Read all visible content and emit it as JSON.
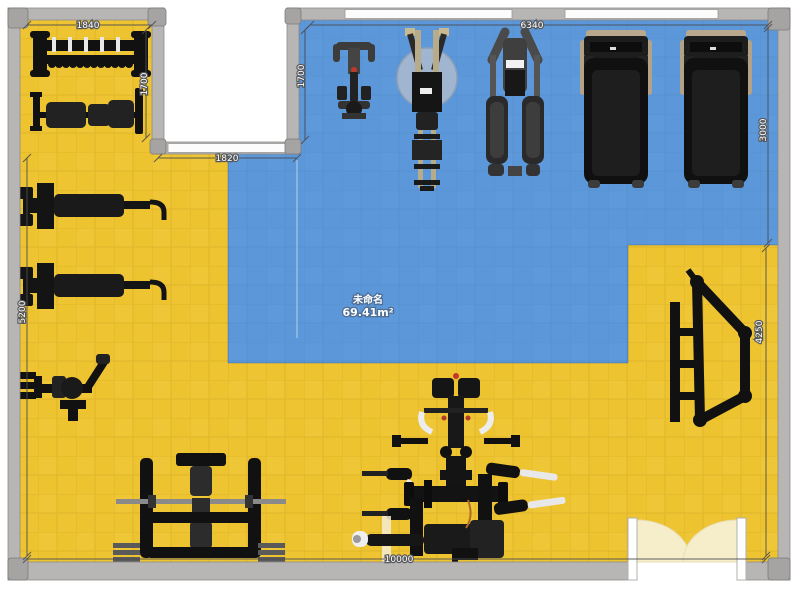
{
  "app": {
    "type": "floor-plan-editor-canvas"
  },
  "zone": {
    "title": "未命名",
    "area": "69.41m²",
    "area_value": 69.41,
    "color": "#5c98d9"
  },
  "floor": {
    "color": "#edc32f"
  },
  "dimensions": {
    "alcove_width": {
      "label": "1840",
      "orientation": "horizontal"
    },
    "alcove_height": {
      "label": "1700",
      "orientation": "vertical"
    },
    "zone_left_height": {
      "label": "1700",
      "orientation": "vertical"
    },
    "notch_width": {
      "label": "1820",
      "orientation": "horizontal"
    },
    "zone_top_width": {
      "label": "6340",
      "orientation": "horizontal"
    },
    "right_upper_height": {
      "label": "3000",
      "orientation": "vertical"
    },
    "right_lower_height": {
      "label": "4250",
      "orientation": "vertical"
    },
    "left_height": {
      "label": "5200",
      "orientation": "vertical"
    },
    "room_width": {
      "label": "10000",
      "orientation": "horizontal"
    }
  },
  "equipment_icons": [
    "dumbbell-rack",
    "adjustable-bench",
    "bench-press-1",
    "bench-press-2",
    "preacher-curl-bench",
    "olympic-bench-press",
    "spin-bike",
    "rowing-machine",
    "elliptical-trainer",
    "treadmill-1",
    "treadmill-2",
    "leg-press-frame",
    "multi-station-machine"
  ],
  "colors": {
    "wall": "#b7b6b4",
    "wall_edge": "#8e8d8b",
    "window": "#fcfcfc",
    "door_leaf": "#f6eecb",
    "equipment_black": "#141414",
    "dim_text": "#ffffff"
  }
}
